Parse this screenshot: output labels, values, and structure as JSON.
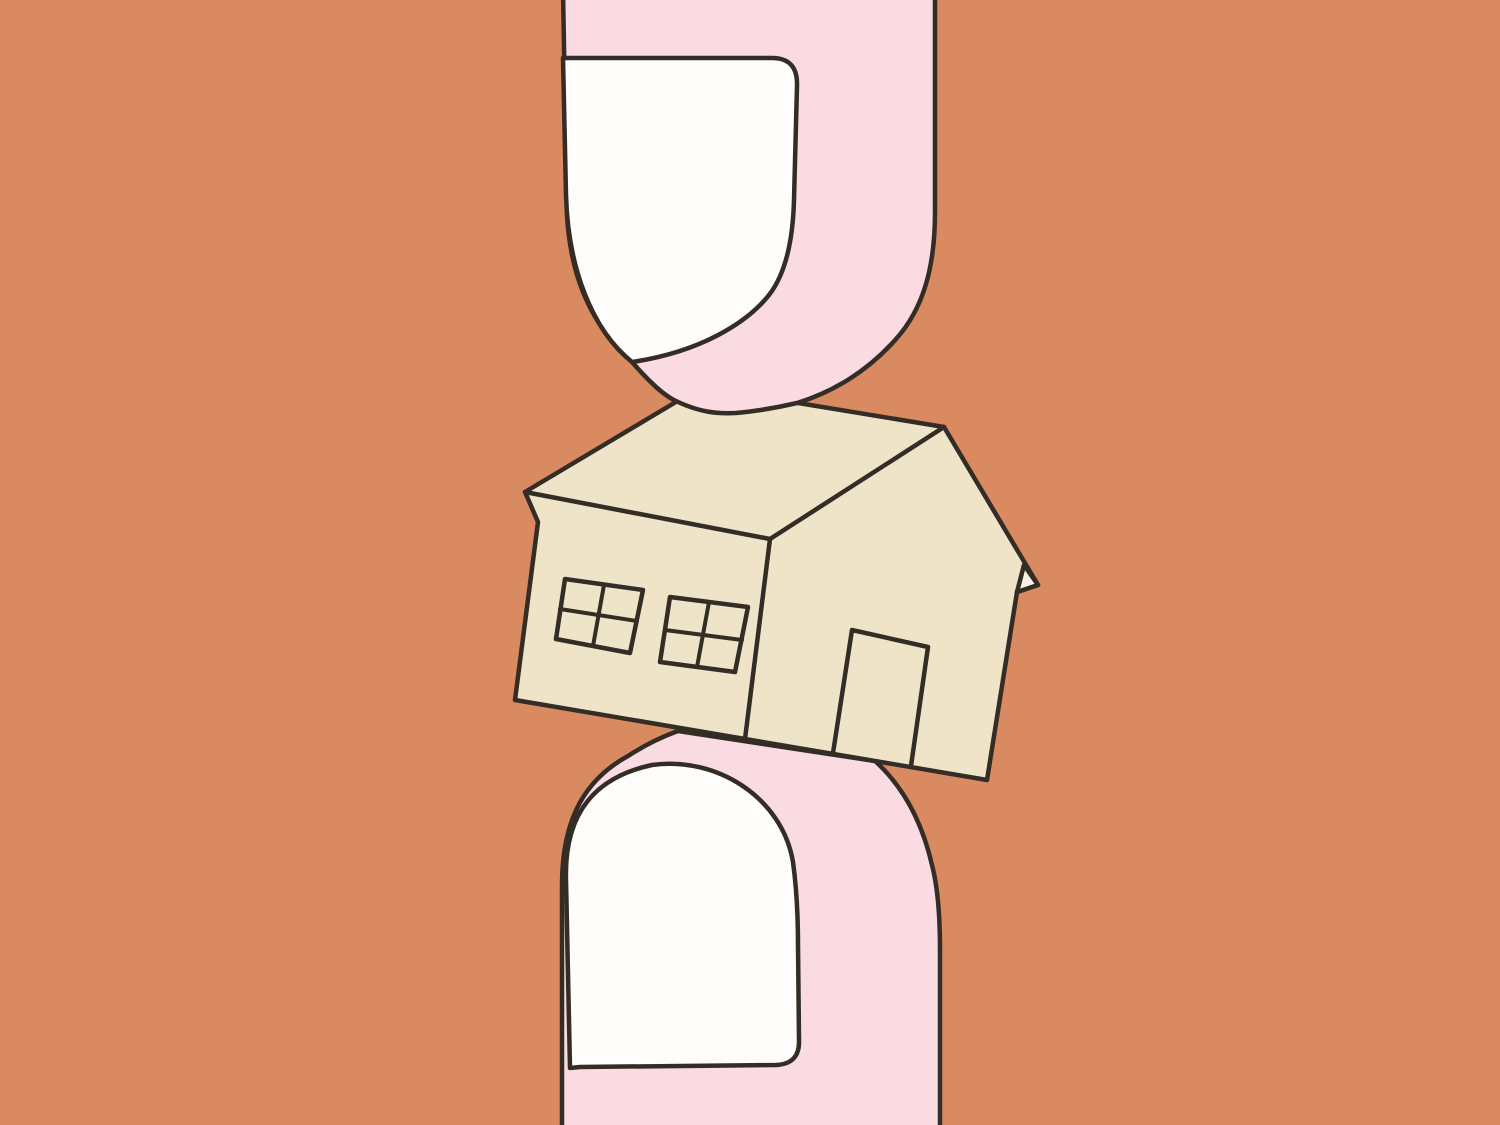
{
  "scene": {
    "alt": "Flat editorial illustration of two fingers pinching a small house between them"
  },
  "colors": {
    "background": "#D98A61",
    "finger_skin": "#FBDBE2",
    "fingernail": "#FEFDFB",
    "house_body": "#F0E4C8",
    "eave_underside": "#F9F2E0",
    "outline": "#332D26"
  }
}
